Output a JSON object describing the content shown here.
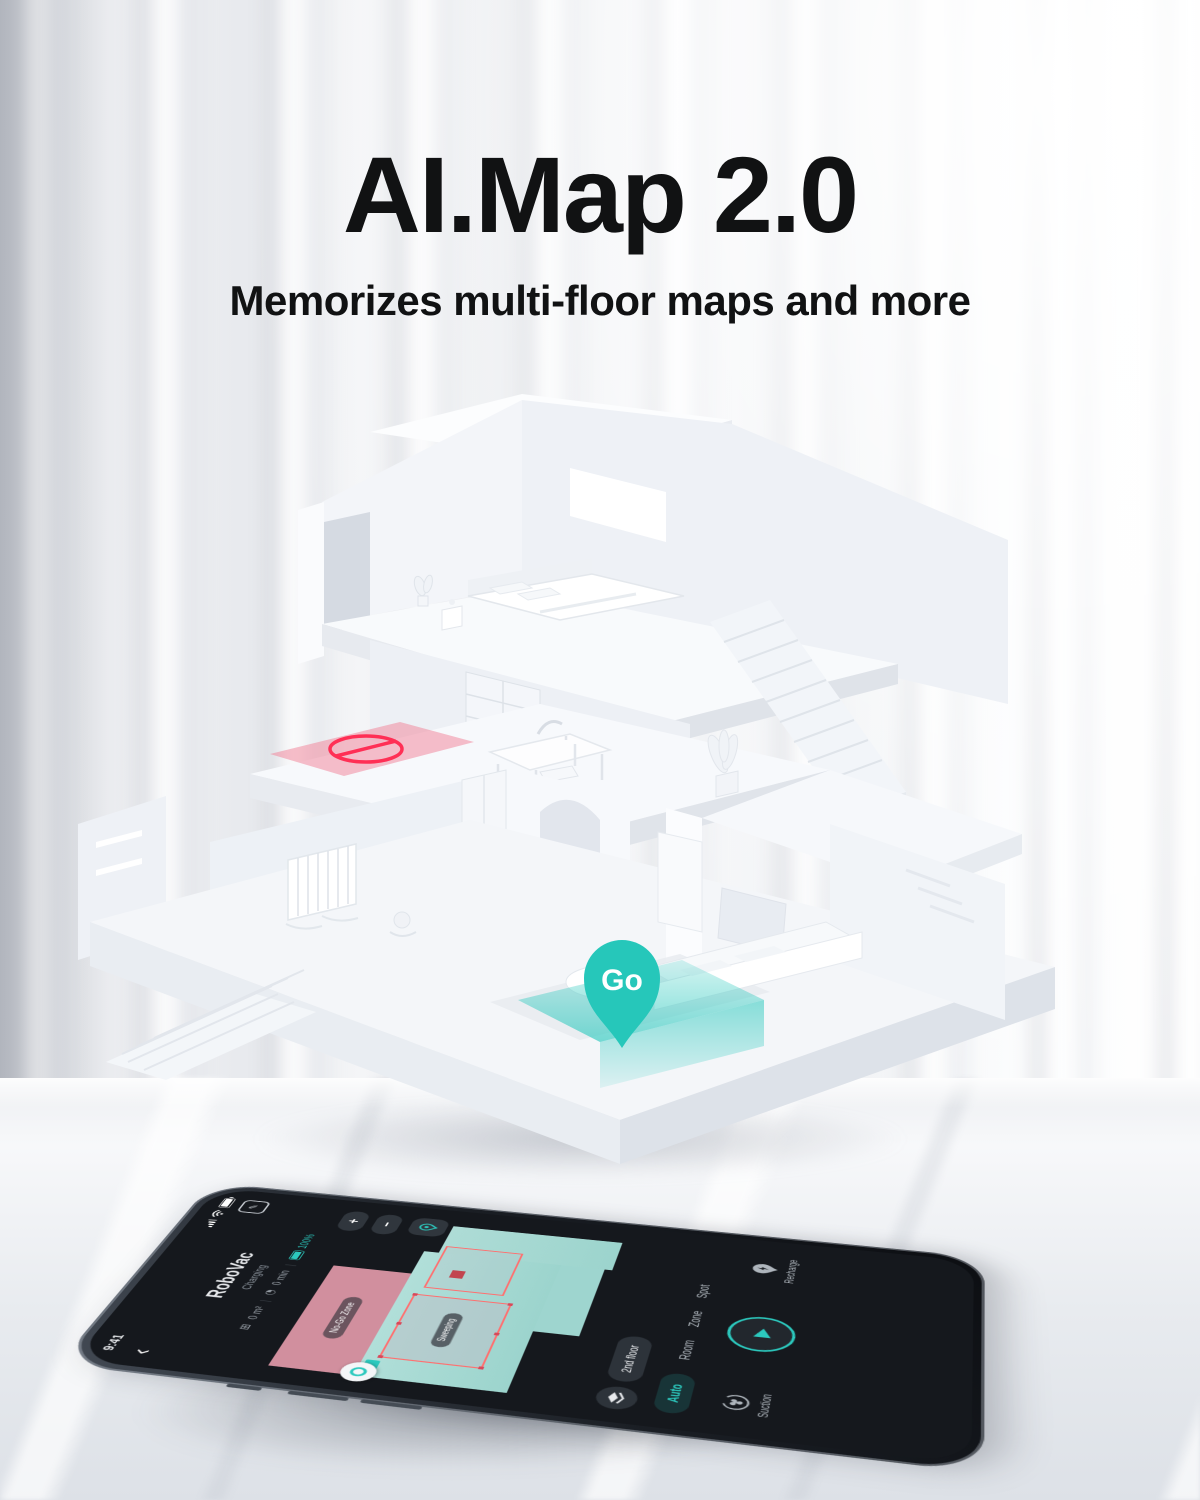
{
  "banner": {
    "title": "AI.Map 2.0",
    "subtitle": "Memorizes multi-floor maps and more"
  },
  "house": {
    "go_pin_label": "Go"
  },
  "phone": {
    "status_bar": {
      "time": "9:41"
    },
    "nav": {
      "back_icon": "‹",
      "edit_icon": "✎"
    },
    "header": {
      "title": "RoboVac",
      "status": "Charging"
    },
    "stats": {
      "area_icon": "⊞",
      "area": "0 m²",
      "duration_icon": "◔",
      "duration": "0 min",
      "battery": "100%"
    },
    "map": {
      "no_go_zone_label": "No-Go Zone",
      "room_label": "Sweeping",
      "zoom_in_label": "+",
      "zoom_out_label": "−"
    },
    "floor_pill": "2nd floor",
    "tabs": [
      {
        "label": "Auto",
        "active": true
      },
      {
        "label": "Room",
        "active": false
      },
      {
        "label": "Zone",
        "active": false
      },
      {
        "label": "Spot",
        "active": false
      }
    ],
    "controls": {
      "suction_label": "Suction",
      "play_icon": "▶",
      "recharge_label": "Recharge"
    }
  },
  "colors": {
    "teal": "#2CC9BE",
    "pink_zone": "#E29AA9",
    "red_outline": "#FF6F6F"
  }
}
